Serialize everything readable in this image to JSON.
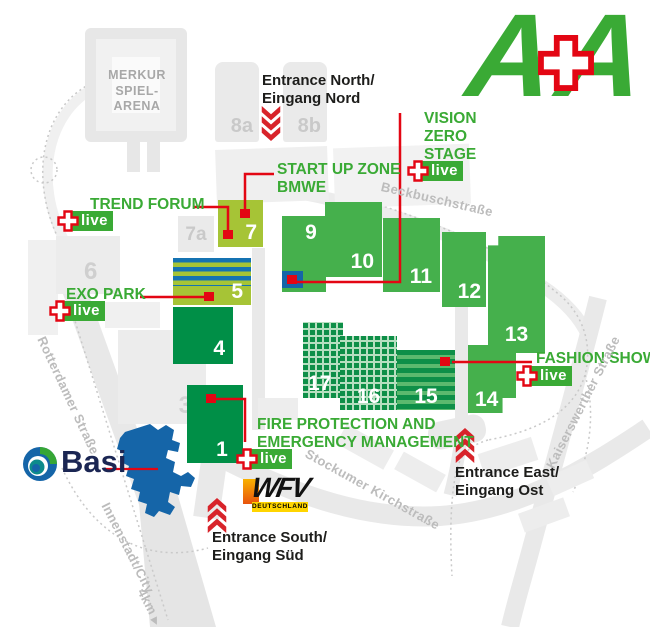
{
  "brand": {
    "letter1": "A",
    "letter2": "A",
    "green": "#3aaa35",
    "red": "#e30613"
  },
  "arena": {
    "line1": "MERKUR",
    "line2": "SPIEL-ARENA"
  },
  "halls": {
    "h1": "1",
    "h3": "3",
    "h4": "4",
    "h5": "5",
    "h6": "6",
    "h7": "7",
    "h7a": "7a",
    "h8a": "8a",
    "h8b": "8b",
    "h9": "9",
    "h10": "10",
    "h11": "11",
    "h12": "12",
    "h13": "13",
    "h14": "14",
    "h15": "15",
    "h16": "16",
    "h17": "17"
  },
  "venues": {
    "trend_forum": "TREND FORUM",
    "startup": {
      "line1": "START UP ZONE",
      "line2": "BMWE"
    },
    "vision": {
      "line1": "VISION",
      "line2": "ZERO",
      "line3": "STAGE"
    },
    "exo_park": "EXO PARK",
    "fire": {
      "line1": "FIRE PROTECTION AND",
      "line2": "EMERGENCY MANAGEMENT"
    },
    "fashion_show": "FASHION SHOW"
  },
  "badge": {
    "live": "live"
  },
  "entrances": {
    "north": {
      "line1": "Entrance North/",
      "line2": "Eingang Nord"
    },
    "south": {
      "line1": "Entrance South/",
      "line2": "Eingang Süd"
    },
    "east": {
      "line1": "Entrance East/",
      "line2": "Eingang Ost"
    }
  },
  "streets": {
    "beckbusch": "Beckbuschstraße",
    "stockumer": "Stockumer Kirchstraße",
    "kaiserswerther": "Kaiserswerther Straße",
    "rotterdamer": "Rotterdamer Straße",
    "innenstadt": "Innenstadt/City",
    "distance": "4km"
  },
  "sponsors": {
    "basi": "Basi",
    "wfv": "WFV",
    "wfv_country": "DEUTSCHLAND"
  },
  "colors": {
    "hall_green": "#45b04c",
    "hall_dark_green": "#008f47",
    "hall_lime": "#a6c436",
    "stripe_blue": "#1573b2",
    "outdoor_blue": "#1565a8",
    "brand_green": "#3aaa35",
    "brand_red": "#e30613",
    "gray_building": "#eaeaea",
    "street_text": "#bcbcbc"
  }
}
